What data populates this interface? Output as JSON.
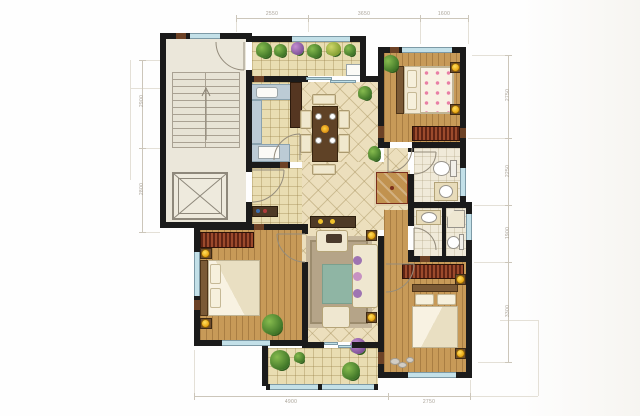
{
  "plan": {
    "type": "residential-apartment-floor-plan",
    "rooms": [
      {
        "name": "stair-core"
      },
      {
        "name": "elevator"
      },
      {
        "name": "entry-foyer"
      },
      {
        "name": "kitchen"
      },
      {
        "name": "terrace"
      },
      {
        "name": "dining-area"
      },
      {
        "name": "hallway"
      },
      {
        "name": "bedroom-top-right"
      },
      {
        "name": "bathroom-ensuite"
      },
      {
        "name": "bathroom-main"
      },
      {
        "name": "master-bedroom"
      },
      {
        "name": "living-room"
      },
      {
        "name": "bedroom-bottom-left"
      },
      {
        "name": "balcony"
      }
    ]
  },
  "colors": {
    "wall": "#1b1b1b",
    "wood_floor": "#c79a58",
    "tile_floor": "#e9ddb2",
    "diag_tile_floor": "#ecdfbd",
    "stair_core": "#ebe7da",
    "window_glass": "#c3e0e8",
    "wardrobe_red": "#9c4a2c",
    "counter_blue": "#bccbd5",
    "rug_teal": "#8fb5a4",
    "lamp_yellow": "#eaa816",
    "plant_green": "#3c7226",
    "dimension_line": "#ccc6ba"
  },
  "dimensions": {
    "top": [
      {
        "label": "2550"
      },
      {
        "label": "3650"
      },
      {
        "label": "1600"
      }
    ],
    "bottom": [
      {
        "label": "4900"
      },
      {
        "label": "2750"
      }
    ],
    "left": [
      {
        "label": "2900"
      },
      {
        "label": "2800"
      }
    ],
    "right": [
      {
        "label": "2750"
      },
      {
        "label": "2250"
      },
      {
        "label": "1900"
      },
      {
        "label": "3300"
      }
    ]
  }
}
